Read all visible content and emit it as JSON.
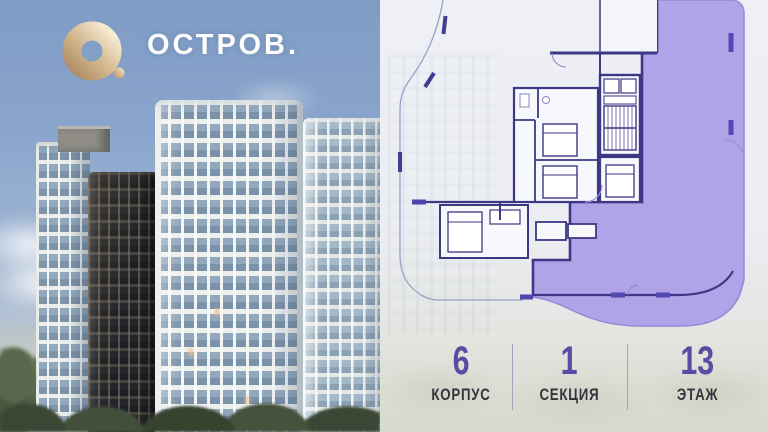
{
  "brand": {
    "logo_text": "ОСТРОВ.",
    "logo_icon": "donut-o-icon"
  },
  "floor_plan": {
    "kind": "apartment-floor-plan",
    "highlighted_unit": "selected-apartment"
  },
  "info_bar": {
    "items": [
      {
        "value": "6",
        "label": "КОРПУС"
      },
      {
        "value": "1",
        "label": "СЕКЦИЯ"
      },
      {
        "value": "13",
        "label": "ЭТАЖ"
      }
    ]
  },
  "colors": {
    "accent_purple": "#584ca3",
    "plan_fill": "#b1a3e7",
    "plan_wall": "#3e3783",
    "window_bar": "#5347b4",
    "label_dark": "#34343c",
    "sky_blue": "#8aa5cc",
    "logo_gold": "#d3b68c"
  }
}
